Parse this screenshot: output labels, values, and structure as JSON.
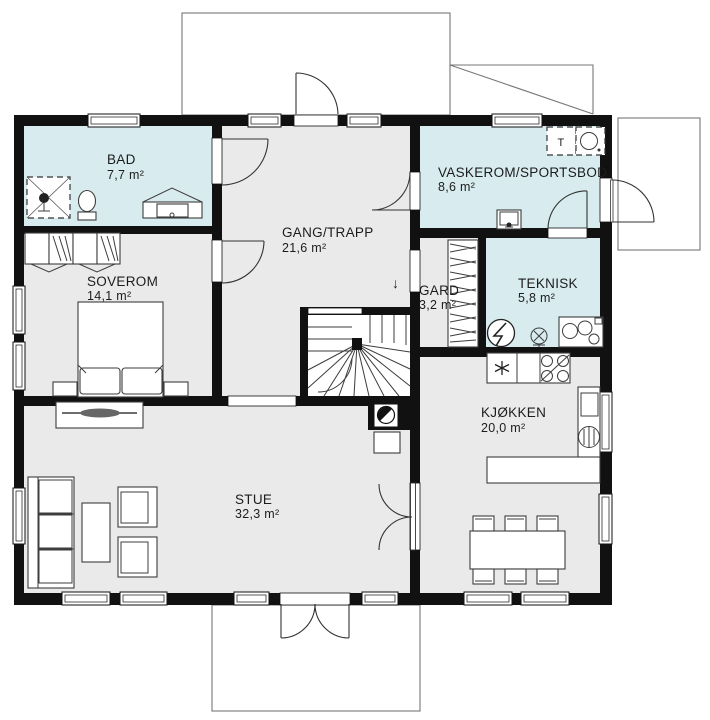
{
  "plan": {
    "rooms": [
      {
        "name": "BAD",
        "area": "7,7 m²"
      },
      {
        "name": "SOVEROM",
        "area": "14,1 m²"
      },
      {
        "name": "GANG/TRAPP",
        "area": "21,6 m²"
      },
      {
        "name": "VASKEROM/SPORTSBOD",
        "area": "8,6 m²"
      },
      {
        "name": "GARD",
        "area": "3,2 m²"
      },
      {
        "name": "TEKNISK",
        "area": "5,8 m²"
      },
      {
        "name": "KJØKKEN",
        "area": "20,0 m²"
      },
      {
        "name": "STUE",
        "area": "32,3 m²"
      }
    ],
    "annotations": {
      "dryer_label": "T",
      "stairs_down_arrow": "↓"
    },
    "icons": {
      "freezer": "snowflake-asterisk",
      "washing_machine": "drum-circle",
      "stove": "four-burners",
      "chimney": "half-filled-circle",
      "electrical_panel": "circle-lightning"
    },
    "colors": {
      "wall": "#111111",
      "wet_room_floor": "#d8ecef",
      "dry_room_floor": "#eaeaea",
      "stair_floor": "#ffffff"
    }
  }
}
